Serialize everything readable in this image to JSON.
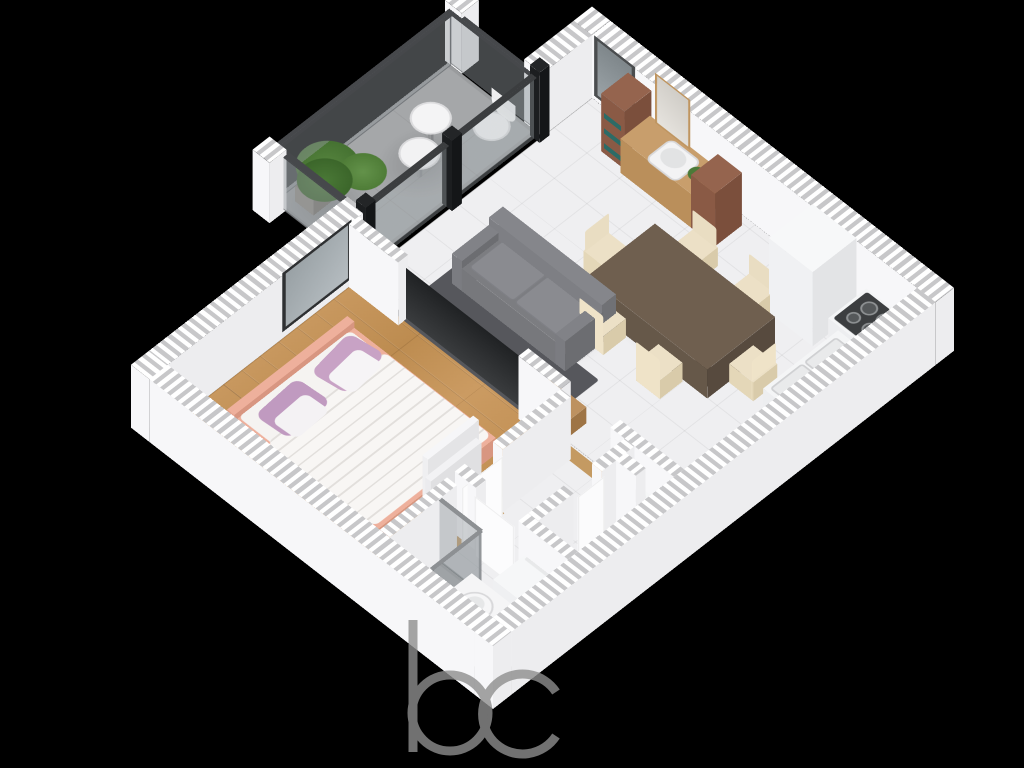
{
  "meta": {
    "title": "Isometric 3D floor plan render — one-bedroom apartment",
    "background": "#000000"
  },
  "watermark": {
    "text": "bc",
    "color": "#8e8e8e"
  },
  "rooms": [
    {
      "id": "balcony",
      "label": "Balcony",
      "floor": "gray concrete"
    },
    {
      "id": "living-dining",
      "label": "Living / Dining Room",
      "floor": "white tile"
    },
    {
      "id": "kitchen",
      "label": "Kitchen corner",
      "floor": "white tile"
    },
    {
      "id": "bedroom",
      "label": "Bedroom",
      "floor": "oak parquet"
    },
    {
      "id": "hallway",
      "label": "Hallway",
      "floor": "white tile"
    },
    {
      "id": "bathroom",
      "label": "Bathroom",
      "floor": "white tile with gray shower tray"
    },
    {
      "id": "wc",
      "label": "WC",
      "floor": "white tile"
    }
  ],
  "furniture": {
    "sofa": "Gray fabric sofa",
    "tv": "Flat-screen TV panel",
    "rug": "Dark gray rug",
    "media_console": "Wooden TV console with red books",
    "dining_table": "Dark wood dining table",
    "dining_chair": "Cream upholstered dining chair",
    "vanity": "Wood console with washbasin, mirror and plant",
    "vanity_cabinet": "Walnut storage cabinet with teal books",
    "fridge": "Refrigerator",
    "cooktop": "Cooktop with four burners",
    "kitchen_sink": "Double kitchen sink counter",
    "bed": "Double bed, salmon frame, white duvet",
    "pillow": "Mauve pillow",
    "wardrobe": "White wardrobe panel",
    "window": "Dark-framed window",
    "glass_door": "Floor-to-ceiling balcony glazing with dark posts",
    "railing": "Glass balcony railing",
    "balcony_table": "Round white bistro table",
    "balcony_chair": "White wire chair",
    "plant": "Potted green plant",
    "shower": "Glass shower enclosure",
    "washbasin": "Round washbasin on counter",
    "washing_machine": "Washing machine",
    "toilet": "Toilet",
    "wc_basin": "Small corner washbasin",
    "door": "Open white interior door"
  },
  "colors": {
    "background": "#000000",
    "wall_face": "#f7f7f9",
    "wall_hatch": "#c7c7c9",
    "tile": "#efeff1",
    "wood_floor": "#c49257",
    "balcony_floor": "#a5a7a9",
    "sofa": "#7c7d81",
    "rug": "#56575c",
    "tv": "#232527",
    "table": "#6f5f4f",
    "chair": "#ece0c6",
    "bed_frame": "#eeb09c",
    "pillow": "#c8a2c5",
    "cabinet": "#8a5a45",
    "glass": "rgba(148,155,159,0.45)",
    "watermark": "#8e8e8e"
  }
}
